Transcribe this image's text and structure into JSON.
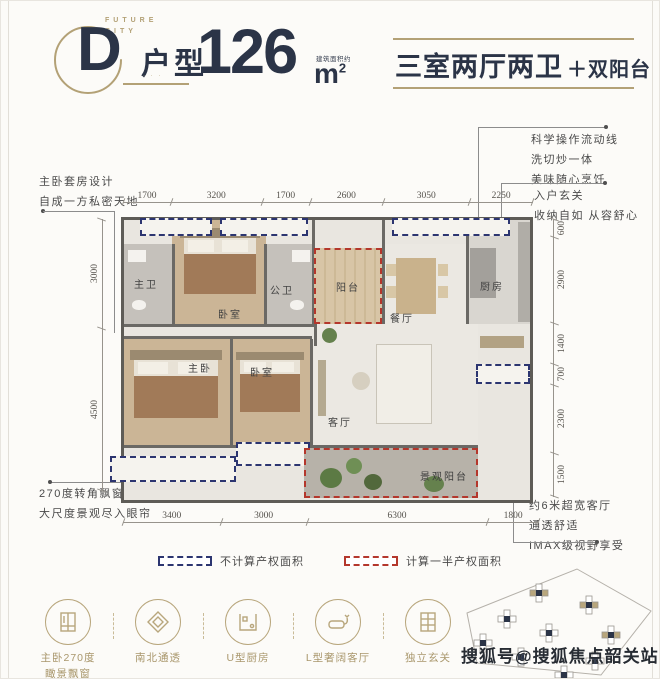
{
  "header": {
    "brand_line1": "FUTURE",
    "brand_line2": "CITY",
    "unit_letter": "D",
    "unit_word": "户型",
    "unit_caption": "· · ·",
    "area_number": "126",
    "area_unit": "m",
    "area_sup": "2",
    "area_note": "建筑面积约",
    "summary_main": "三室两厅两卫",
    "summary_extra": "＋双阳台"
  },
  "annotations": {
    "master_suite": [
      "主卧套房设计",
      "自成一方私密天地"
    ],
    "kitchen_flow": [
      "科学操作流动线",
      "洗切炒一体",
      "美味随心烹饪"
    ],
    "entry": [
      "入户玄关",
      "收纳自如 从容舒心"
    ],
    "corner_window": [
      "270度转角飘窗",
      "大尺度景观尽入眼帘"
    ],
    "wide_living": [
      "约6米超宽客厅",
      "通透舒适",
      "IMAX级视野享受"
    ]
  },
  "dims": {
    "top": [
      "1700",
      "3200",
      "1700",
      "2600",
      "3050",
      "2250"
    ],
    "bottom": [
      "3400",
      "3000",
      "6300",
      "1800"
    ],
    "left": [
      "3000",
      "4500"
    ],
    "right": [
      "600",
      "2900",
      "1400",
      "700",
      "2300",
      "1500"
    ]
  },
  "rooms": {
    "master_bath": "主卫",
    "bedroom_top": "卧室",
    "guest_bath": "公卫",
    "balcony": "阳台",
    "dining": "餐厅",
    "kitchen": "厨房",
    "master_bedroom": "主卧",
    "bedroom_mid": "卧室",
    "living": "客厅",
    "view_balcony": "景观阳台"
  },
  "legend": {
    "excluded": "不计算产权面积",
    "half": "计算一半产权面积"
  },
  "features": [
    {
      "line1": "主卧270度",
      "line2": "瞰景飘窗"
    },
    {
      "line1": "南北通透",
      "line2": ""
    },
    {
      "line1": "U型厨房",
      "line2": ""
    },
    {
      "line1": "L型奢阔客厅",
      "line2": ""
    },
    {
      "line1": "独立玄关",
      "line2": ""
    }
  ],
  "watermark": "搜狐号@搜狐焦点韶关站",
  "colors": {
    "gold": "#b3a176",
    "navy": "#2b3447",
    "blue_dash": "#2c3570",
    "red_dash": "#b4372c"
  }
}
